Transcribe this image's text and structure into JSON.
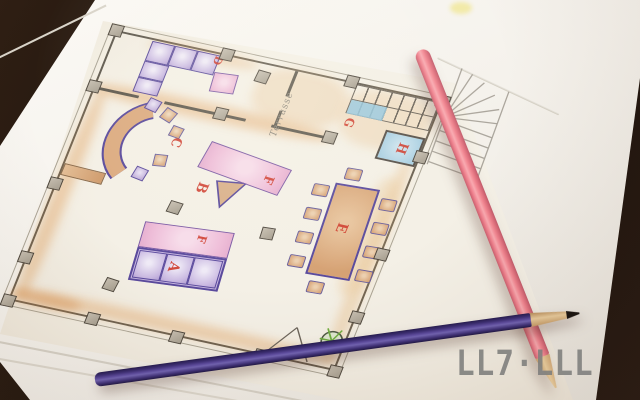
{
  "watermark": {
    "text": "LL7·LLL",
    "color": "#7e7e7c"
  },
  "floor_plan": {
    "area_label": "Terrasse",
    "label_color": "#cf3a2b",
    "labels": {
      "sofa_a": "A",
      "stool_b": "B",
      "curved_sofa_c": "C",
      "ottoman_d": "D",
      "dining_table_e": "E",
      "table_f_center": "F",
      "table_f_lounge": "F",
      "stairs_g": "G",
      "lift_h": "H"
    },
    "colors": {
      "wall": "#5f594e",
      "column_fill": "#b8b0a3",
      "purple_fill": "#c9b8e1",
      "purple_outline": "#5a4a9c",
      "pink_fill": "#eebcd8",
      "pink_outline": "#7c58a4",
      "tan_fill": "#d9a87c",
      "blue_fill": "#a9cfe2",
      "wash_orange": "#e2a35c",
      "plant_green": "#6fae3f"
    }
  },
  "pencils": [
    {
      "name": "pink colored pencil",
      "color": "#ee7f8c"
    },
    {
      "name": "purple colored pencil",
      "color": "#4a3a8a"
    }
  ]
}
